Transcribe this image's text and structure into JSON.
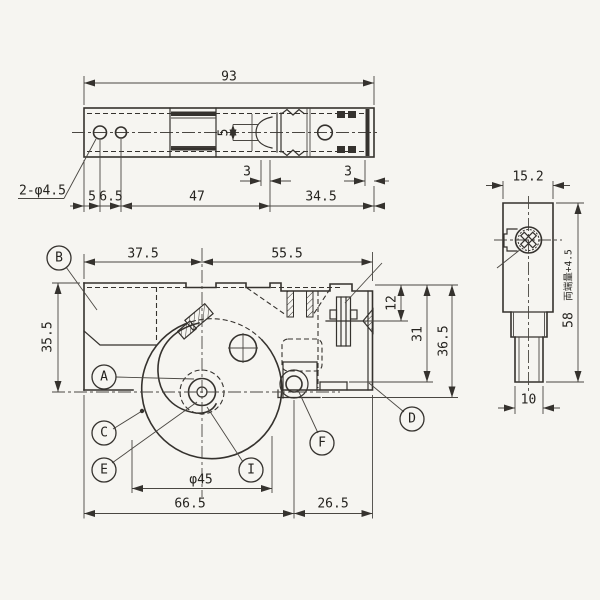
{
  "meta": {
    "background_color": "#f6f5f1",
    "ink_color": "#35322e",
    "drawing_type": "mechanical-three-view"
  },
  "top_view": {
    "dim_total_width": "93",
    "dim_slot_height": "5",
    "dim_gap_left": "3",
    "dim_gap_right": "3",
    "dim_hole1_offset": "5",
    "dim_hole2_offset": "6.5",
    "dim_mid_span": "47",
    "dim_right_span": "34.5",
    "holes_note": "2-φ4.5"
  },
  "front_view": {
    "dim_left_span": "37.5",
    "dim_right_span": "55.5",
    "dim_left_height": "35.5",
    "dim_screw_offset": "12",
    "dim_step_depth": "31",
    "dim_total_depth": "36.5",
    "dim_cam_diameter": "φ45",
    "dim_base_left": "66.5",
    "dim_base_right": "26.5",
    "balloons": {
      "a": "A",
      "b": "B",
      "c": "C",
      "d": "D",
      "e": "E",
      "f": "F",
      "i": "I"
    }
  },
  "side_view": {
    "dim_width": "15.2",
    "dim_height": "58",
    "dim_height_note": "両端量+4.5",
    "dim_shaft_width": "10"
  }
}
